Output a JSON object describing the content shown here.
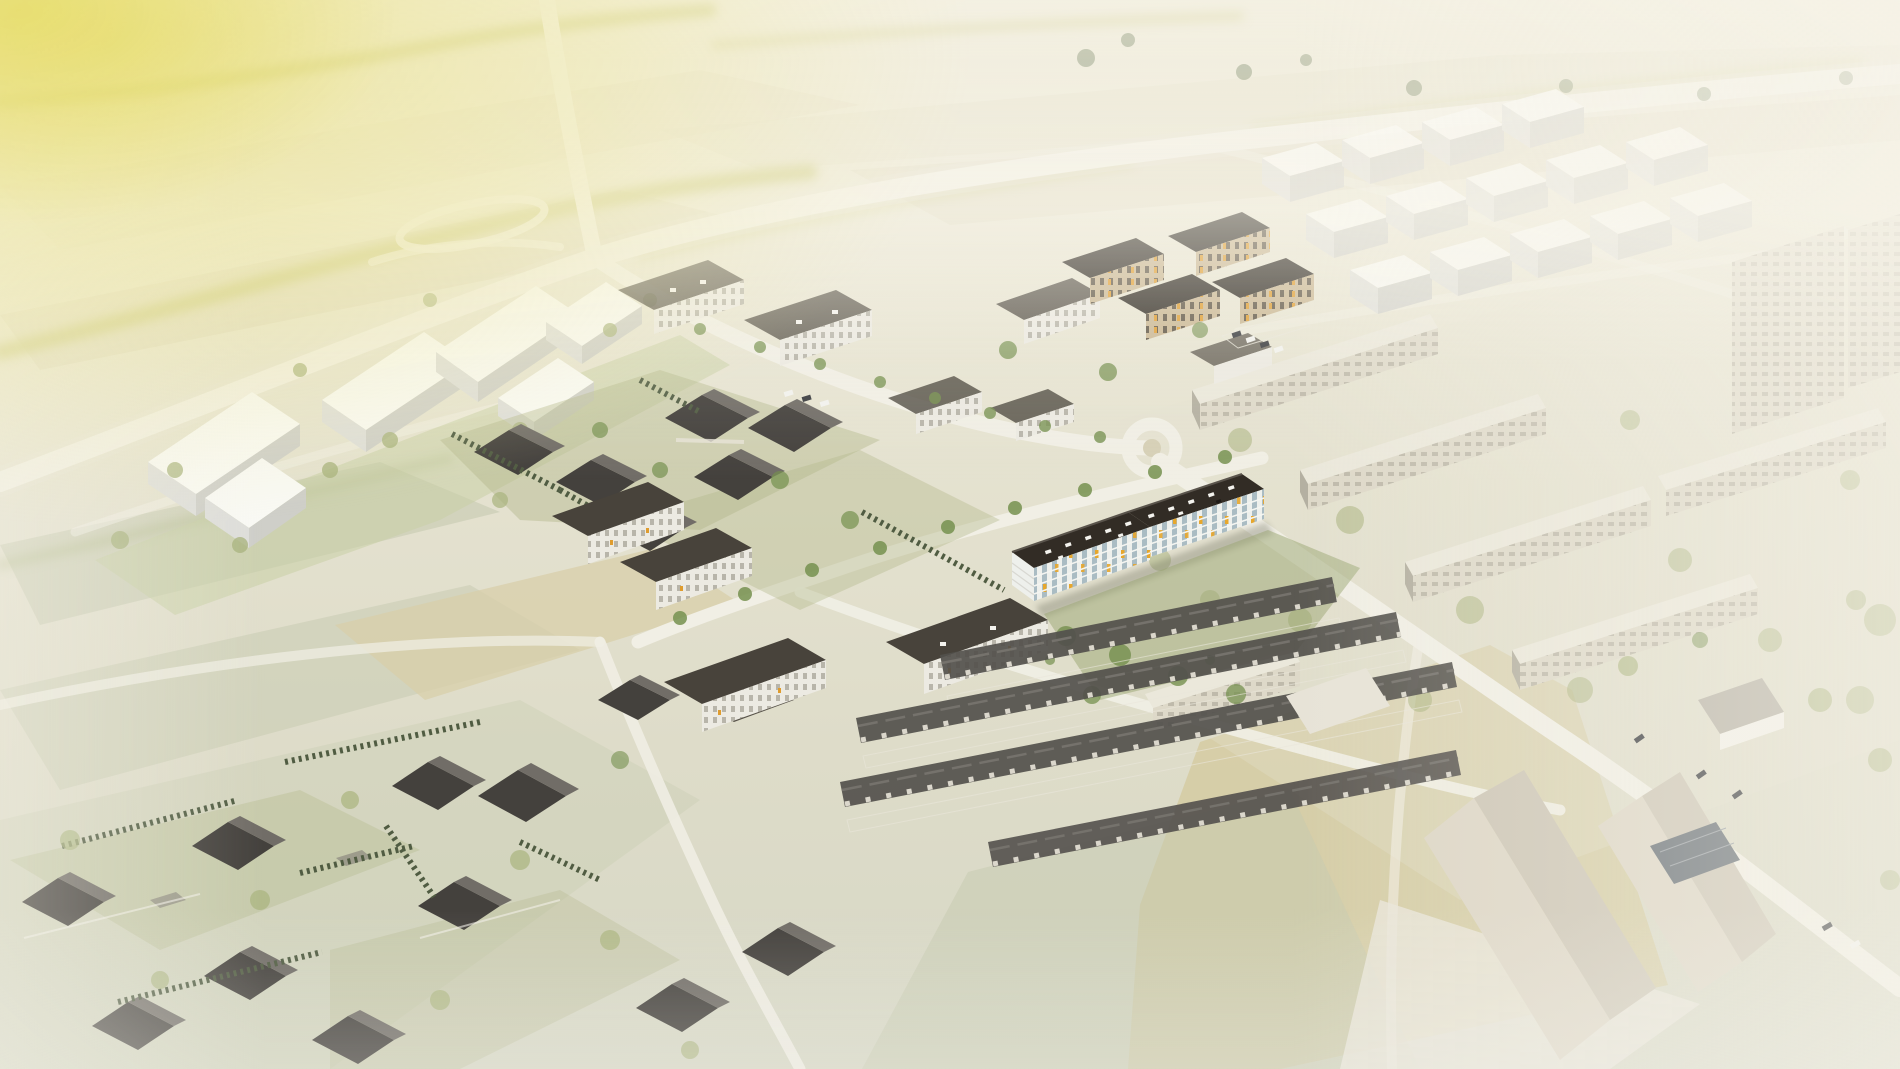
{
  "scene": {
    "description": "Hazy aerial architectural rendering of a suburban development: a highlighted dark-roofed apartment building with yellow window accents sits among washed-out farm fields, a road interchange, white concept massing blocks, apartment clusters, rows of pitched-roof terraced houses, detached homes with hedges, long panel housing slabs on the right and farm buildings in the lower right, with a warm yellow sun glow in the upper-left corner."
  },
  "palette": {
    "base-top": "#ece8d5",
    "base-mid": "#e7e4d2",
    "base-low": "#dedcc9",
    "base-bottom": "#d6d7c5",
    "field-a": "#e2ddc6",
    "field-b": "#d9d3ba",
    "field-tan": "#d8cfa9",
    "field-gold": "#d5cba0",
    "field-green": "#c6cab0",
    "road": "#f1efe5",
    "road-faint": "#e9e6da",
    "hedgerow": "#c3c26e",
    "tree-green": "#75904f",
    "tree-washed": "#a9b37e",
    "tree-dark": "#55673f",
    "cypress": "#505c42",
    "lawn": "#c9d0a6",
    "garden-green": "#9aa671",
    "white-top": "#f9f9f4",
    "white-side": "#dededa",
    "white-front": "#cfcfc9",
    "roof-dark": "#48433b",
    "roof-black": "#2f2a23",
    "wall-white": "#eceae2",
    "warm-wall": "#c9b692",
    "warm-accent": "#df9c2e",
    "panel-wall": "#ded9c9",
    "panel-roof": "#ebe8db",
    "panel-win": "#b4b0a1",
    "hero-roof": "#322c25",
    "hero-roof-edge": "#5a544c",
    "hero-wall": "#eef0ec",
    "hero-glass": "#8ba4b0",
    "hero-accent": "#e7a72c",
    "hero-line": "#f4f5f1",
    "house-roof": "#44413d",
    "house-roof-lit": "#716d67",
    "house-wall": "#e7e3d8",
    "terrace-roof": "#53504c",
    "terrace-ridge": "#75726c",
    "terrace-wall": "#dbd7cc",
    "farm-lit": "#ddd6c6",
    "farm-dark": "#cdc6b6",
    "solar": "#687077",
    "farm-yard": "#e9e5da",
    "car-dark": "#3a3c40",
    "car-white": "#f2f2ee",
    "shadow": "#5f604f",
    "glow": "#e8dd6f"
  }
}
